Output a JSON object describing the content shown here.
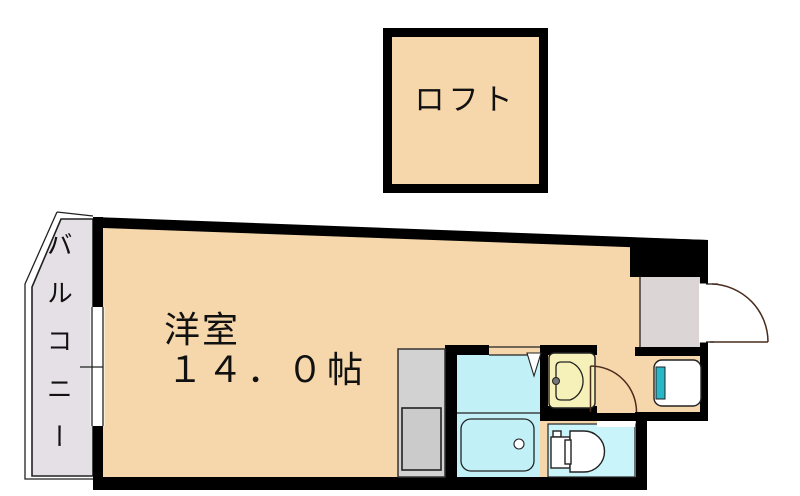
{
  "plan": {
    "loft_label": "ロフト",
    "room_label": "洋室",
    "room_size": "１４．０帖",
    "balcony_label": "バルコニー"
  },
  "colors": {
    "wall": "#000000",
    "line": "#222222",
    "door_line": "#4a2c1e",
    "room_fill": "#f6d7ab",
    "bath_fill": "#c2f0f7",
    "toilet_fill": "#c9f4fa",
    "vanity_fill": "#f5f1b9",
    "kitchen_fill": "#d2d2d2",
    "entry_fill": "#dcd5d5",
    "balcony_fill": "#e5e0e5",
    "washer_accent": "#29b6c6"
  }
}
